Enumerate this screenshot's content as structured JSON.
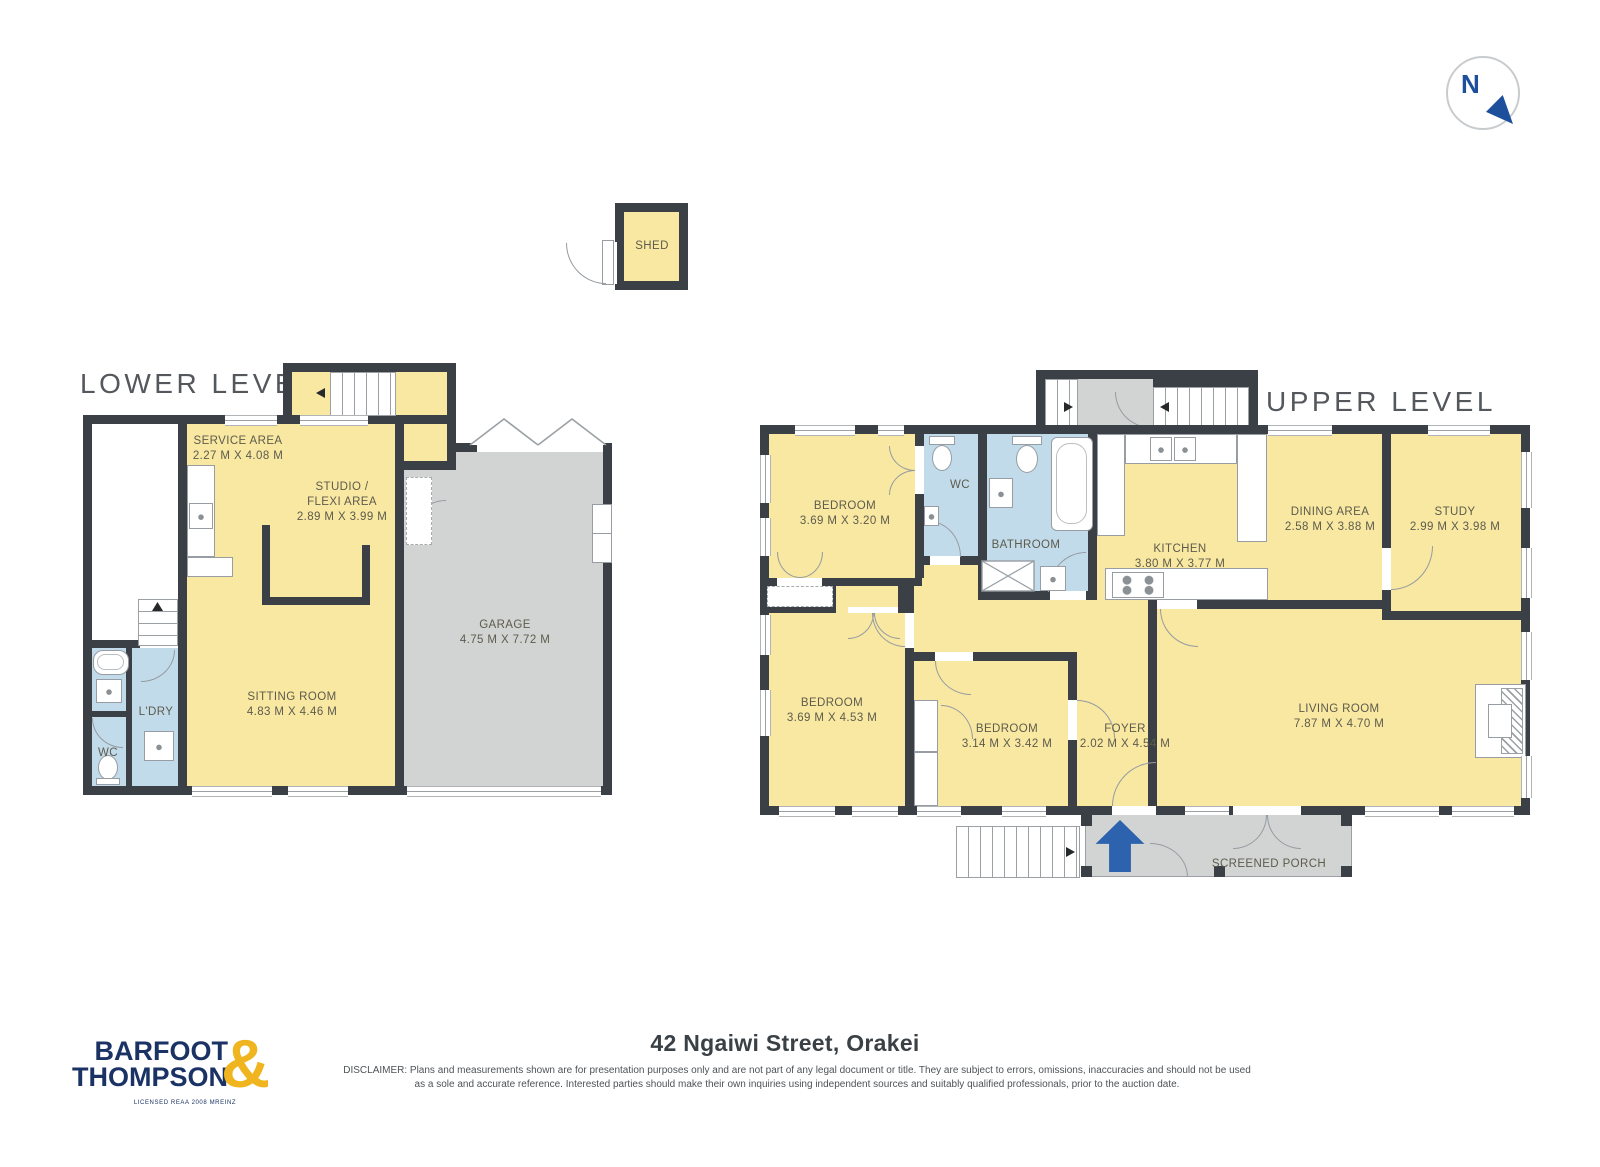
{
  "compass": {
    "letter": "N"
  },
  "titles": {
    "lower": "LOWER LEVEL",
    "upper": "UPPER LEVEL"
  },
  "shed": {
    "name": "SHED"
  },
  "lower": {
    "service": {
      "name": "SERVICE AREA",
      "dims": "2.27 M X 4.08 M"
    },
    "studio": {
      "name": "STUDIO / FLEXI AREA",
      "dims": "2.89 M X 3.99 M"
    },
    "sitting": {
      "name": "SITTING ROOM",
      "dims": "4.83 M X 4.46 M"
    },
    "garage": {
      "name": "GARAGE",
      "dims": "4.75 M X 7.72 M"
    },
    "wc": {
      "name": "WC"
    },
    "laundry": {
      "name": "L'DRY"
    }
  },
  "upper": {
    "bedroom1": {
      "name": "BEDROOM",
      "dims": "3.69 M X 3.20 M"
    },
    "bedroom2": {
      "name": "BEDROOM",
      "dims": "3.69 M X 4.53 M"
    },
    "bedroom3": {
      "name": "BEDROOM",
      "dims": "3.14 M X 3.42 M"
    },
    "wc": {
      "name": "WC"
    },
    "bathroom": {
      "name": "BATHROOM"
    },
    "kitchen": {
      "name": "KITCHEN",
      "dims": "3.80 M X 3.77 M"
    },
    "dining": {
      "name": "DINING AREA",
      "dims": "2.58 M X 3.88 M"
    },
    "study": {
      "name": "STUDY",
      "dims": "2.99 M X 3.98 M"
    },
    "foyer": {
      "name": "FOYER",
      "dims": "2.02 M X 4.54 M"
    },
    "living": {
      "name": "LIVING ROOM",
      "dims": "7.87 M X 4.70 M"
    },
    "porch": {
      "name": "SCREENED PORCH"
    }
  },
  "footer": {
    "address": "42 Ngaiwi Street, Orakei",
    "disclaimer_line1": "DISCLAIMER: Plans and measurements shown are for presentation purposes only and are not part of any legal document or title. They are subject to errors, omissions, inaccuracies and should not be used",
    "disclaimer_line2": "as a sole and accurate reference. Interested parties should make their own inquiries using independent sources and suitably qualified professionals, prior to the auction date."
  },
  "logo": {
    "line1": "BARFOOT",
    "line2": "THOMPSON",
    "ampersand": "&",
    "tagline": "LICENSED REAA 2008 MREINZ"
  },
  "colors": {
    "room_fill": "#F9E8A2",
    "wet_room_fill": "#C2DBEB",
    "wall": "#3A4045",
    "garage_fill": "#D2D4D4",
    "entry_arrow_blue": "#2D62AE",
    "logo_navy": "#1B3364",
    "logo_gold": "#F0B41E",
    "compass_blue": "#1D4F9C"
  }
}
